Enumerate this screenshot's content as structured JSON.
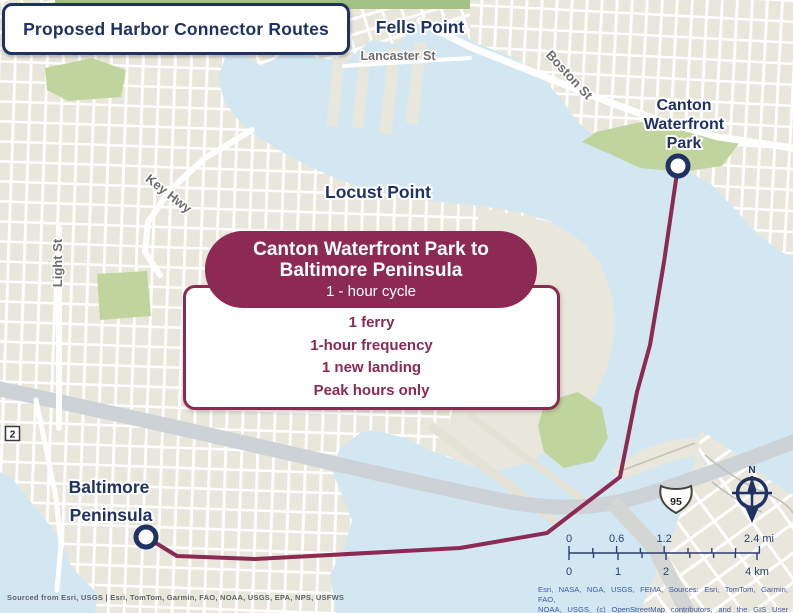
{
  "title": "Proposed Harbor Connector Routes",
  "map_labels": {
    "fells_point": "Fells Point",
    "locust_point": "Locust Point",
    "canton_line1": "Canton",
    "canton_line2": "Waterfront",
    "canton_line3": "Park",
    "baltimore_line1": "Baltimore",
    "baltimore_line2": "Peninsula"
  },
  "street_labels": {
    "lancaster": "Lancaster St",
    "boston": "Boston St",
    "key_hwy": "Key Hwy",
    "light": "Light St"
  },
  "callout": {
    "title_line1": "Canton Waterfront Park to",
    "title_line2": "Baltimore Peninsula",
    "subtitle": "1 - hour cycle",
    "details": [
      "1 ferry",
      "1-hour frequency",
      "1 new landing",
      "Peak hours only"
    ]
  },
  "route_shields": {
    "interstate": "95",
    "state": "2"
  },
  "compass": {
    "north_label": "N"
  },
  "scale_bar": {
    "miles": {
      "t0": "0",
      "t1": "0.6",
      "t2": "1.2",
      "t3": "2.4 mi"
    },
    "kilometers": {
      "t0": "0",
      "t1": "1",
      "t2": "2",
      "t3": "4 km"
    }
  },
  "attribution": {
    "left": "Sourced from Esri, USGS | Esri, TomTom, Garmin, FAO, NOAA, USGS, EPA, NPS, USFWS",
    "right_line1": "Esri, NASA, NGA, USGS, FEMA, Sources: Esri, TomTom, Garmin, FAO,",
    "right_line2": "NOAA, USGS, (c) OpenStreetMap contributors, and the GIS User"
  },
  "colors": {
    "route": "#8c2a53",
    "navy": "#1f3263",
    "water": "#d2e7f2",
    "land": "#e9e7db",
    "park_green": "#c0d49d",
    "road_gray": "#cdd2d6"
  }
}
